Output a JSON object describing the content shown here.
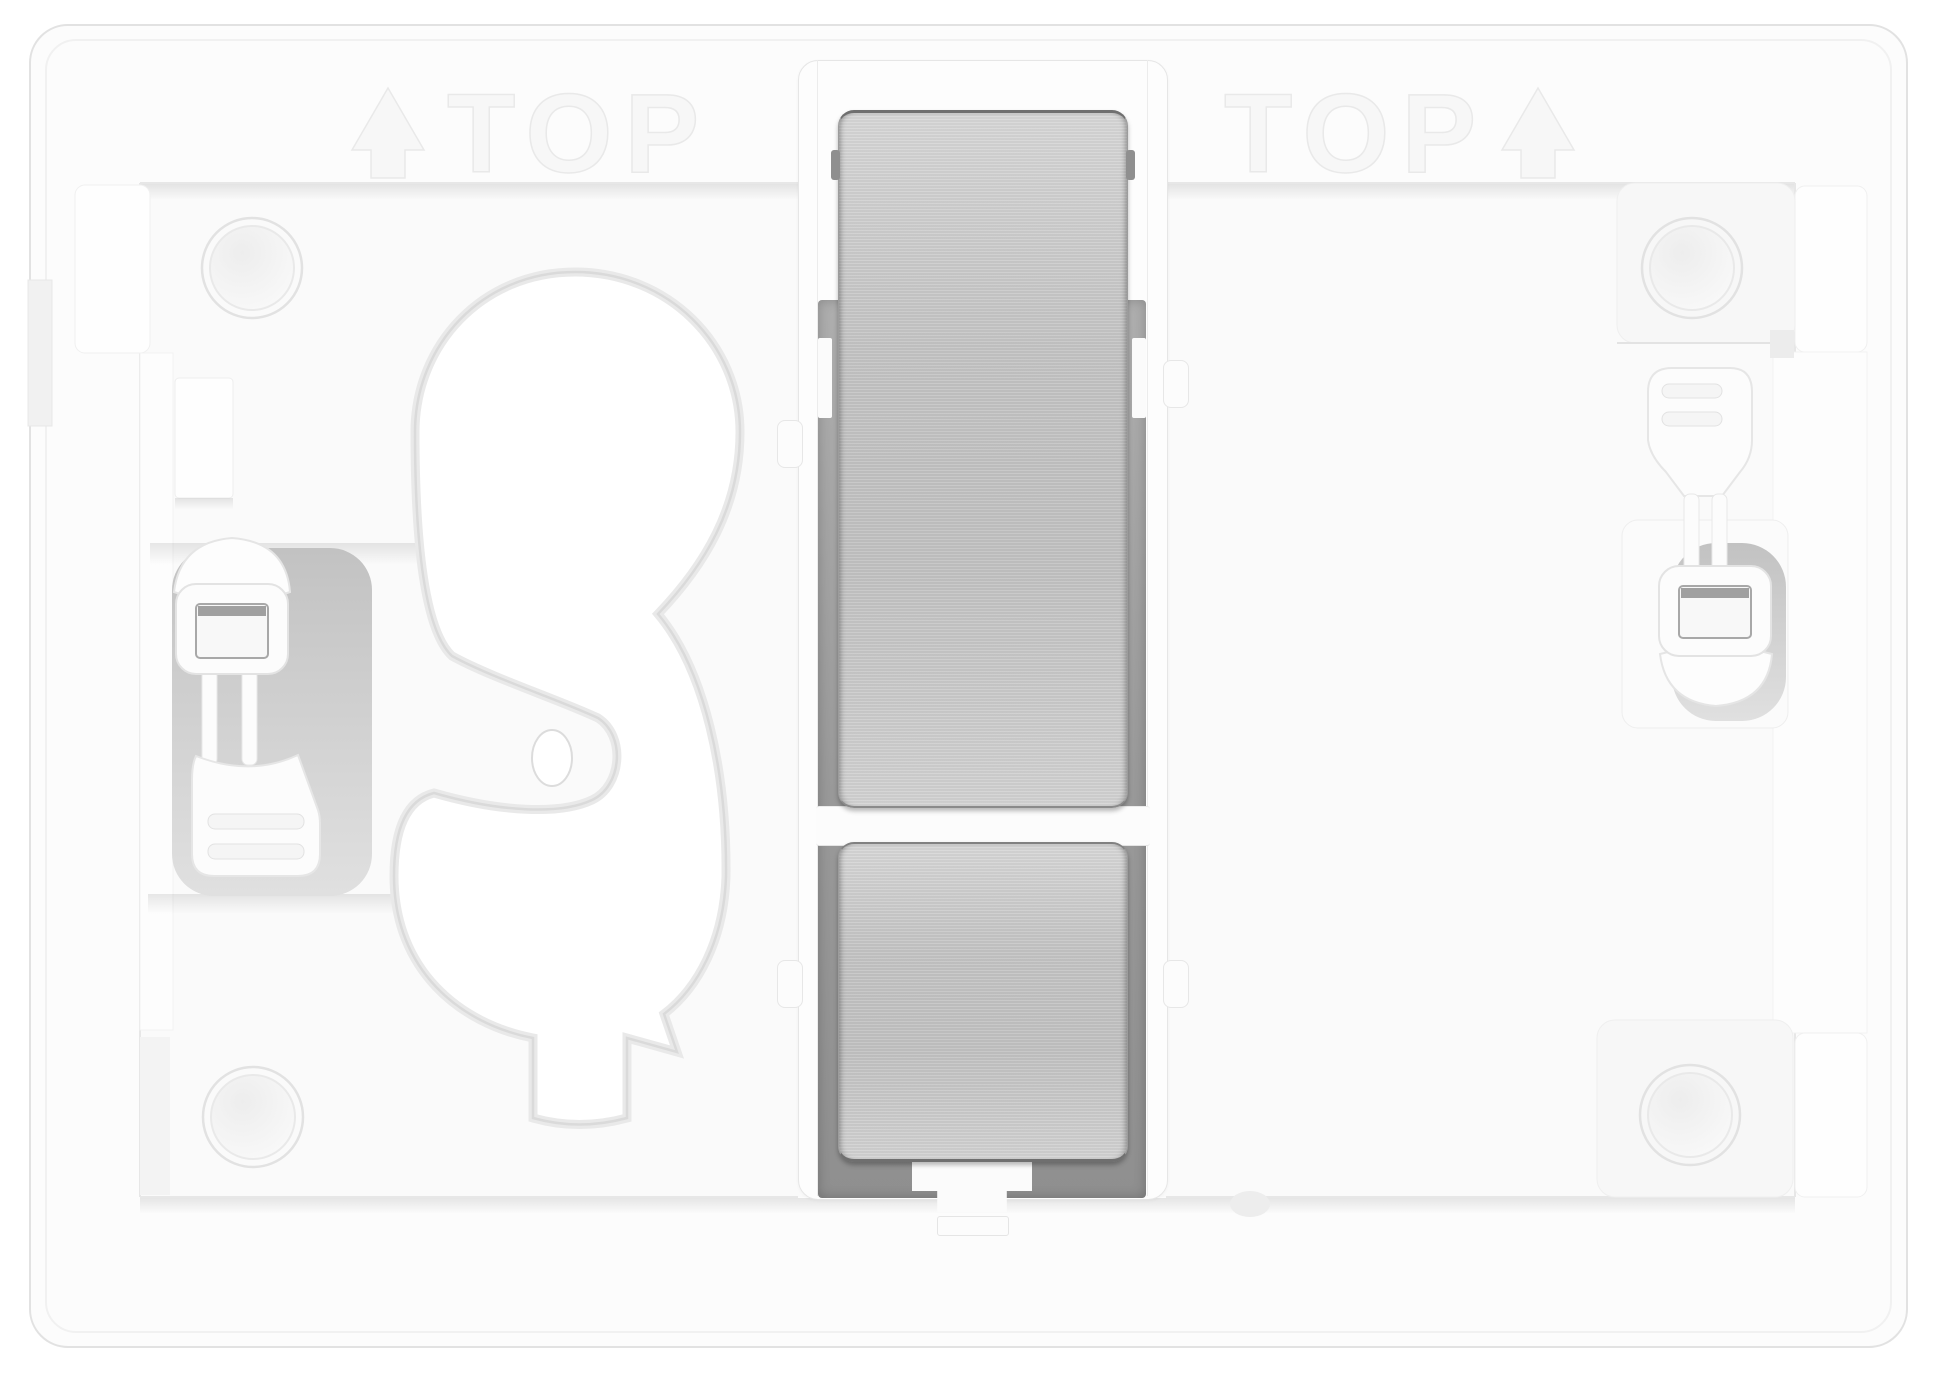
{
  "scene": {
    "description": "Rear view of a white plastic dual-module mounting grid frame with two brushed stainless-steel rocker modules and two white plastic fixing clips",
    "background": "#ffffff"
  },
  "markings": {
    "left": {
      "icon": "up-arrow-icon",
      "label": "TOP"
    },
    "right": {
      "label": "TOP",
      "icon": "up-arrow-icon"
    }
  },
  "colors": {
    "plate": "#fcfcfc",
    "plate_edge": "#e2e2e2",
    "interior": "#fafafa",
    "emboss_fill": "#f7f7f7",
    "emboss_stroke": "#e9e9e9",
    "recess_dark": "#989898",
    "clip_pocket_dark": "#c2c2c2",
    "clip_pocket_light": "#e0e0e0",
    "steel_light": "#d6d6d6",
    "steel_mid": "#c0c0c0",
    "steel_edge": "#6f6f6f",
    "cutout_white": "#ffffff"
  },
  "parts": {
    "frame": "mounting-frame-plate",
    "top_module": "tall brushed-steel rocker module",
    "bottom_module": "short brushed-steel rocker module",
    "left_clip": "white fixing clip with buckle and slotted paddle (paddle down)",
    "right_clip": "white fixing clip with buckle and slotted paddle (paddle up)",
    "screw_boss_count": "4",
    "cutout": "central keyhole-shaped cutout with drilled tab",
    "bottom_latch": "stepped latch tab below lower module"
  }
}
